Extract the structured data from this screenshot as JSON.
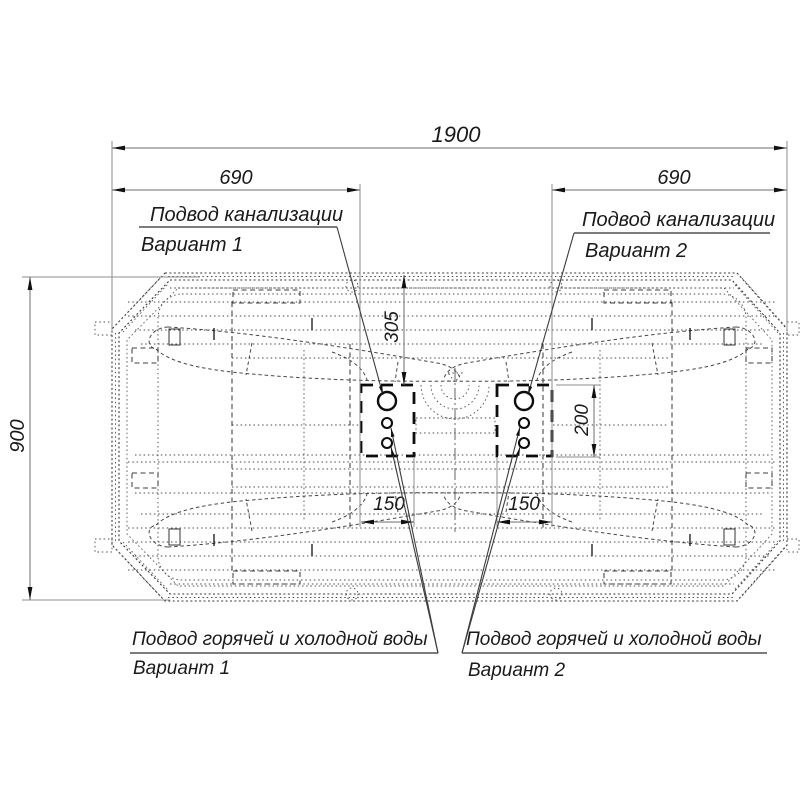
{
  "drawing": {
    "title_semantic": "Схема подключения ванны",
    "dims": {
      "overall_length": "1900",
      "zone1_offset": "690",
      "zone2_offset": "690",
      "overall_width": "900",
      "sewer_offset": "305",
      "zone_height": "200",
      "zone1_width": "150",
      "zone2_width": "150"
    },
    "labels": {
      "sewer1_line1": "Подвод канализации",
      "sewer1_line2": "Вариант 1",
      "sewer2_line1": "Подвод канализации",
      "sewer2_line2": "Вариант 2",
      "water1_line1": "Подвод горячей и холодной воды",
      "water1_line2": "Вариант 1",
      "water2_line1": "Подвод горячей и холодной воды",
      "water2_line2": "Вариант 2"
    },
    "colors": {
      "line": "#383838",
      "bold_line": "#0d0d0d",
      "dim_line": "#6e6e6e",
      "text": "#1a1a1a",
      "background": "#ffffff"
    }
  }
}
